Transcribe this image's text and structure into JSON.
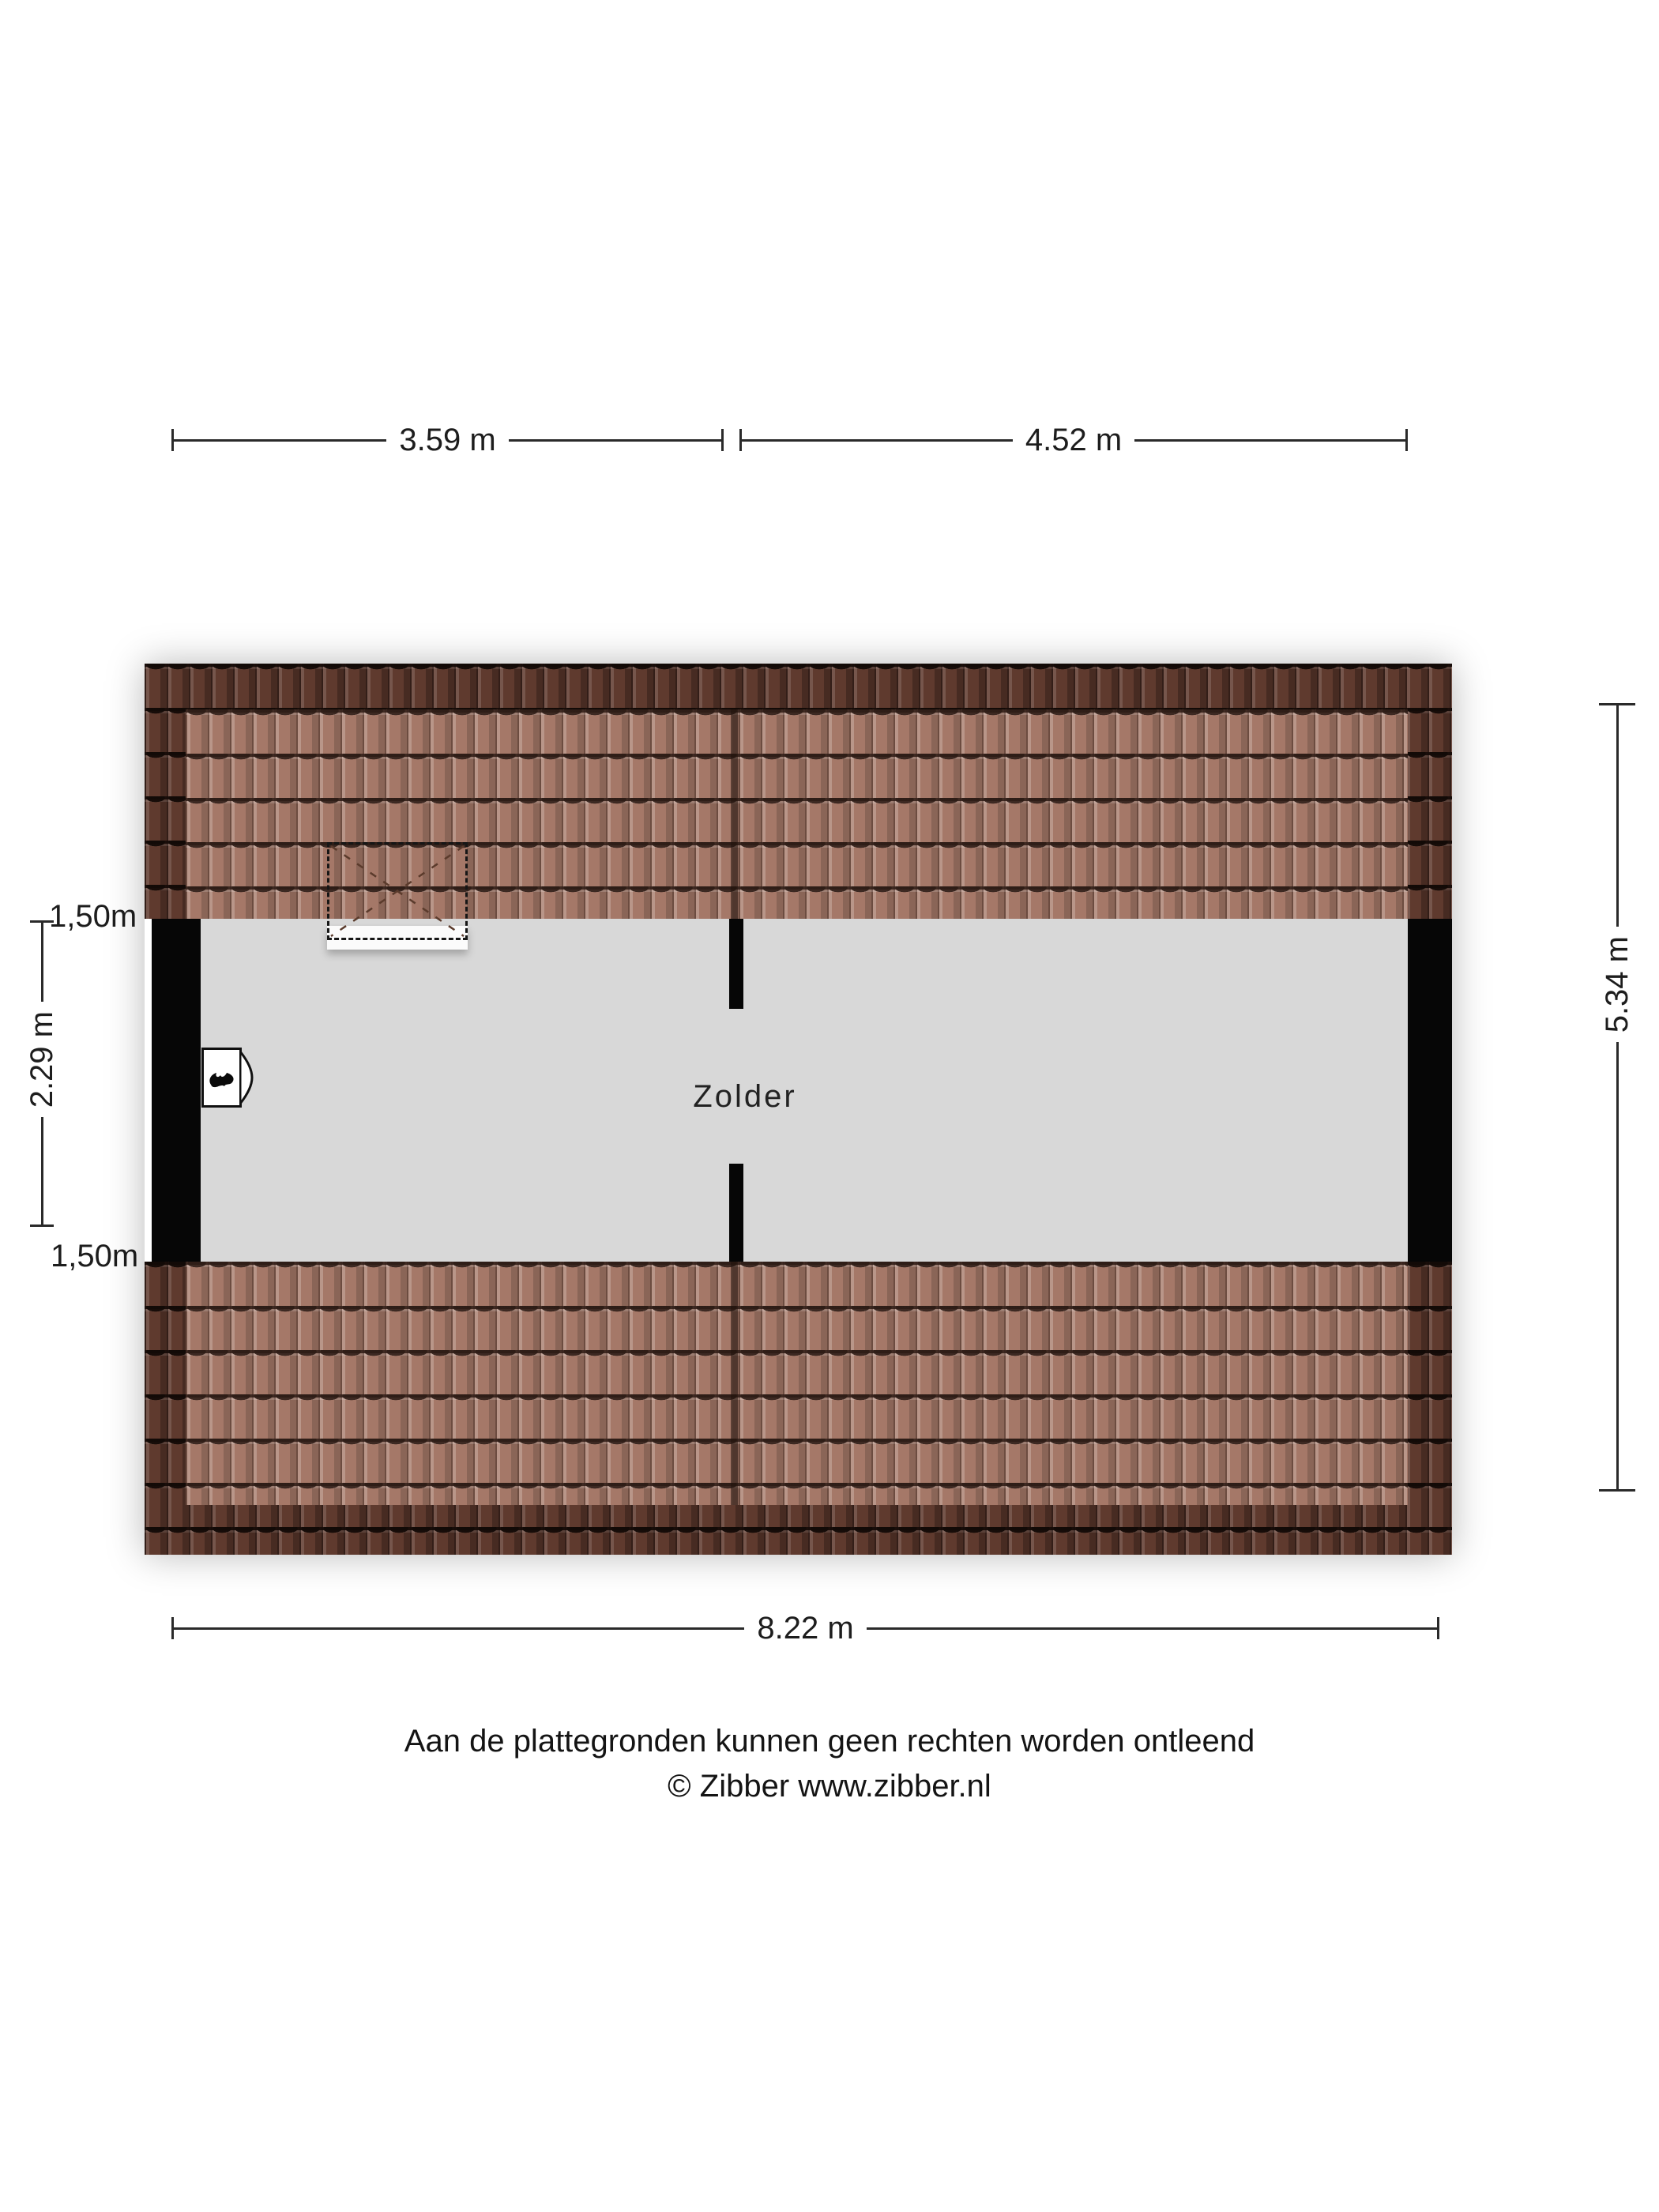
{
  "plan": {
    "room_label": "Zolder",
    "colors": {
      "floor": "#d8d8d8",
      "wall": "#060606",
      "roof_tile_dark": "#5f3a2e",
      "roof_tile_light": "#a57868",
      "background": "#ffffff"
    }
  },
  "dimensions": {
    "top": [
      {
        "label": "3.59 m"
      },
      {
        "label": "4.52 m"
      }
    ],
    "bottom": {
      "label": "8.22 m"
    },
    "left": {
      "top_label": "1,50m",
      "middle_label": "2.29 m",
      "bottom_label": "1,50m"
    },
    "right": {
      "label": "5.34 m"
    }
  },
  "footer": {
    "line1": "Aan de plattegronden kunnen geen rechten worden ontleend",
    "line2": "© Zibber www.zibber.nl"
  }
}
